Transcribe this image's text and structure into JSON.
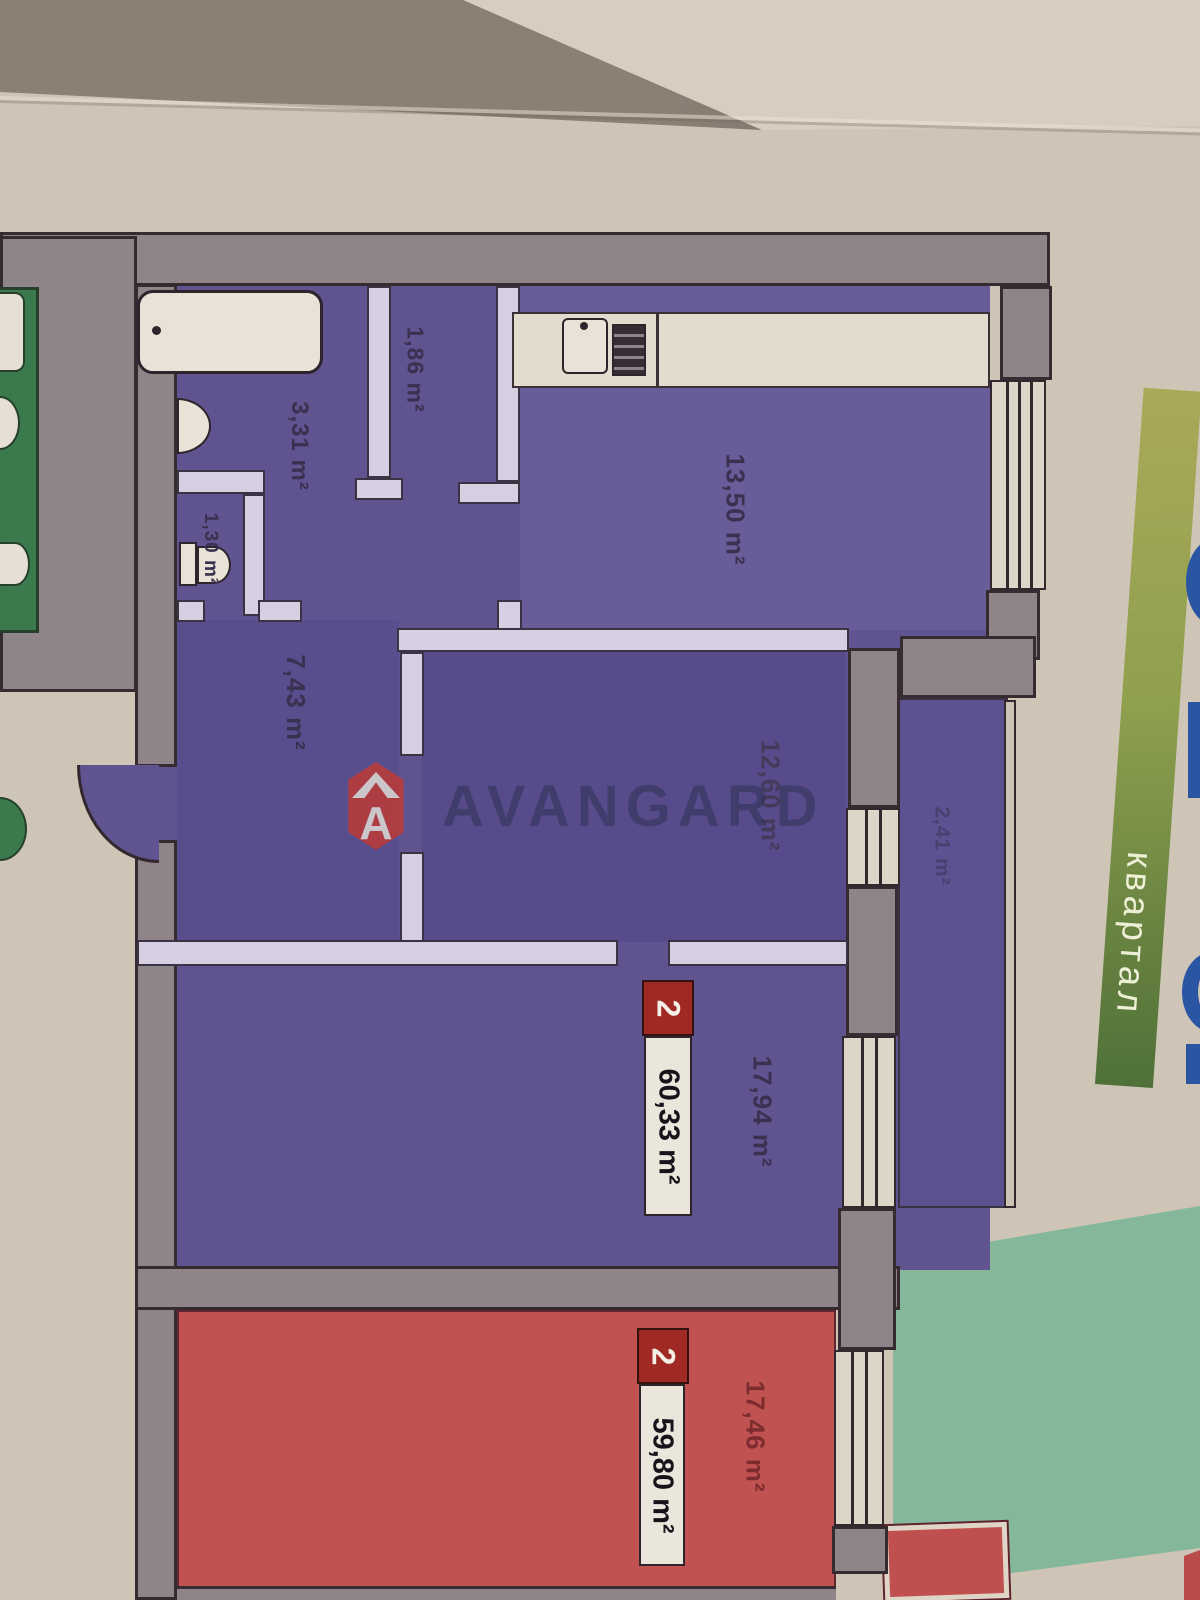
{
  "brand": {
    "name": "AVANGARD",
    "logo_letter": "A"
  },
  "banner": {
    "label": "квартал"
  },
  "apartment_purple": {
    "badge": "2",
    "total_area": "60,33 m²",
    "rooms": {
      "kitchen": "13,50 m²",
      "bathroom": "3,31 m²",
      "storage": "1,86 m²",
      "wc": "1,30 m²",
      "hall": "7,43 m²",
      "bedroom": "12,60 m²",
      "living_room": "17,94 m²",
      "loggia": "2,41 m²"
    }
  },
  "apartment_red": {
    "badge": "2",
    "total_area": "59,80 m²",
    "rooms": {
      "living_room": "17,46 m²"
    }
  },
  "colors": {
    "page": "#cec5b6",
    "wall_gray": "#8f8487",
    "purple_room": "#5f5490",
    "red_room": "#c05351",
    "badge_red": "#a02a23",
    "teal_block": "#85b79b",
    "banner_green_top": "#aaa958",
    "banner_green_bottom": "#4e7038",
    "adjacent_green": "#3a7a4d",
    "watermark_navy": "#2b3450",
    "cropped_blue_text": "#2a55a3"
  }
}
